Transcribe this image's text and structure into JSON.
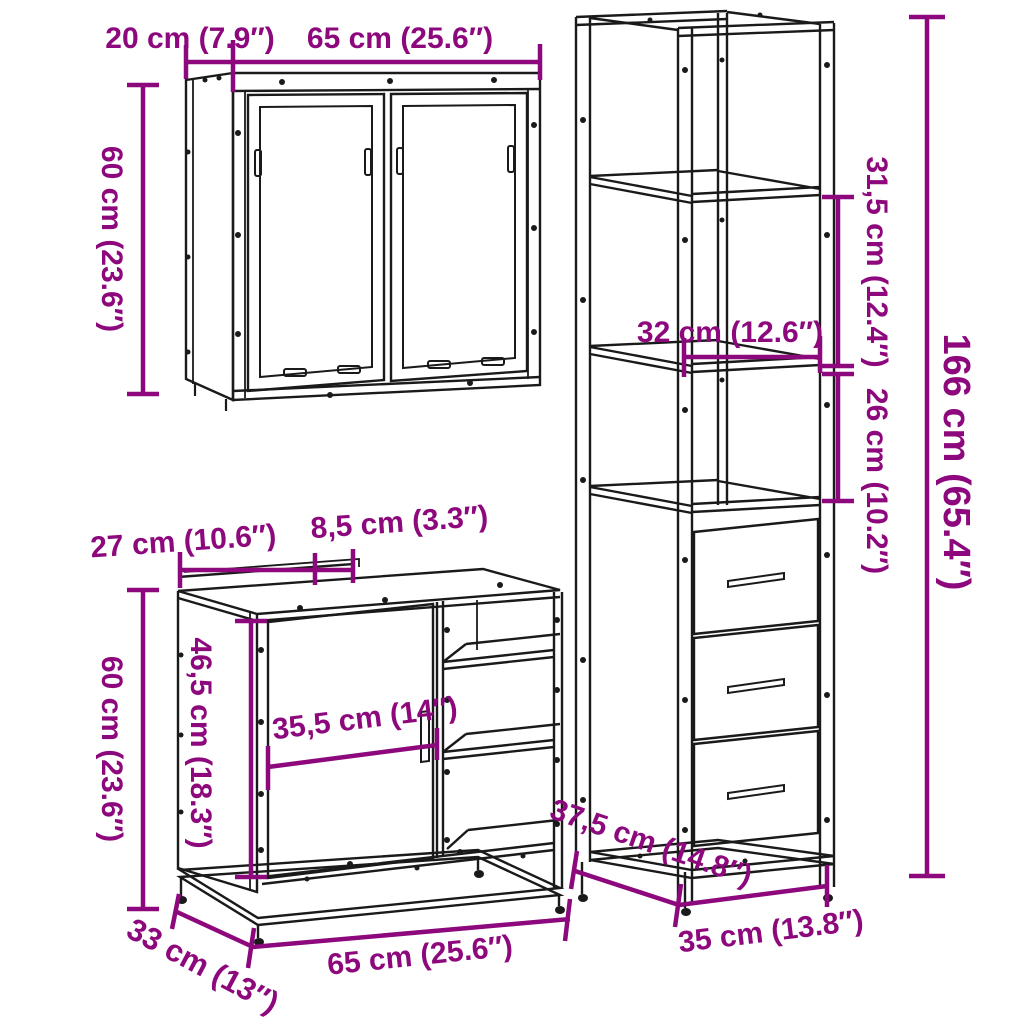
{
  "colors": {
    "dimension": "#8D087C",
    "line": "#1A1A1A",
    "background": "#FFFFFF"
  },
  "labels": {
    "wall_cabinet": {
      "depth": "20 cm (7.9″)",
      "width": "65 cm (25.6″)",
      "height": "60 cm (23.6″)"
    },
    "tall_cabinet": {
      "upper_compartment_height": "31,5 cm (12.4″)",
      "shelf_width": "32 cm (12.6″)",
      "lower_compartment_height": "26 cm (10.2″)",
      "height": "166 cm (65.4″)",
      "depth": "37,5 cm (14.8″)",
      "width": "35 cm (13.8″)"
    },
    "sink_cabinet": {
      "back_left_width": "27 cm (10.6″)",
      "back_notch_width": "8,5 cm (3.3″)",
      "height": "60 cm (23.6″)",
      "front_frame_height": "46,5 cm (18.3″)",
      "door_width": "35,5 cm (14″)",
      "depth": "33 cm (13″)",
      "width": "65 cm (25.6″)"
    }
  }
}
